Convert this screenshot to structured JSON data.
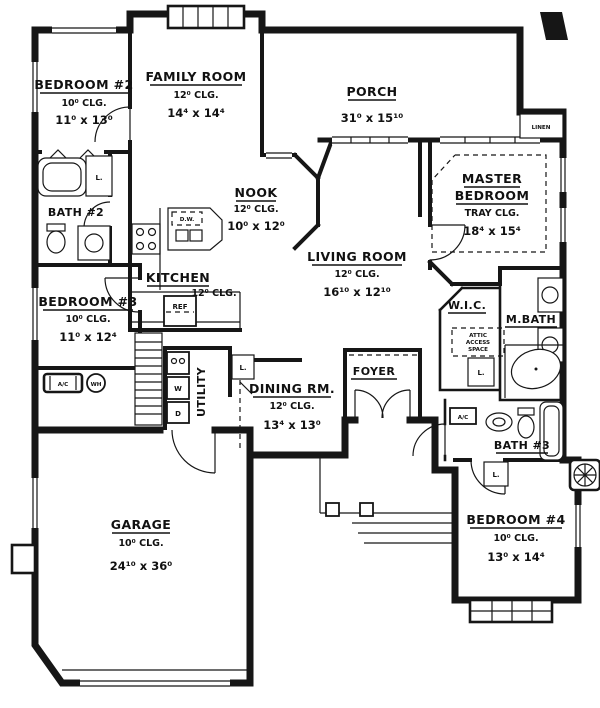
{
  "rooms": {
    "bedroom2": {
      "label": "BEDROOM #2",
      "clg": "10⁰ CLG.",
      "dims": "11⁰ x 13⁰"
    },
    "familyRoom": {
      "label": "FAMILY ROOM",
      "clg": "12⁰ CLG.",
      "dims": "14⁴ x 14⁴"
    },
    "porch": {
      "label": "PORCH",
      "dims": "31⁰ x 15¹⁰"
    },
    "master": {
      "label1": "MASTER",
      "label2": "BEDROOM",
      "clg": "TRAY CLG.",
      "dims": "18⁴ x 15⁴"
    },
    "nook": {
      "label": "NOOK",
      "clg": "12⁰ CLG.",
      "dims": "10⁰ x 12⁰"
    },
    "living": {
      "label": "LIVING ROOM",
      "clg": "12⁰ CLG.",
      "dims": "16¹⁰ x 12¹⁰"
    },
    "bath2": {
      "label": "BATH #2"
    },
    "bedroom3": {
      "label": "BEDROOM #3",
      "clg": "10⁰ CLG.",
      "dims": "11⁰ x 12⁴"
    },
    "kitchen": {
      "label": "KITCHEN",
      "clg": "12⁰ CLG."
    },
    "wic": {
      "label": "W.I.C."
    },
    "mbath": {
      "label": "M.BATH"
    },
    "utility": {
      "label": "UTILITY"
    },
    "dining": {
      "label": "DINING RM.",
      "clg": "12⁰ CLG.",
      "dims": "13⁴ x 13⁰"
    },
    "foyer": {
      "label": "FOYER"
    },
    "bath3": {
      "label": "BATH #3"
    },
    "bedroom4": {
      "label": "BEDROOM #4",
      "clg": "10⁰ CLG.",
      "dims": "13⁰ x 14⁴"
    },
    "garage": {
      "label": "GARAGE",
      "clg": "10⁰ CLG.",
      "dims": "24¹⁰ x 36⁰"
    }
  },
  "annotations": {
    "linen": "LINEN",
    "closet": "L.",
    "ac": "A/C",
    "waterHeater": "WH",
    "dishwasher": "D.W.",
    "refrigerator": "REF",
    "washer": "W",
    "dryer": "D",
    "attic1": "ATTIC",
    "attic2": "ACCESS",
    "attic3": "SPACE"
  },
  "colors": {
    "ink": "#161616",
    "paper": "#ffffff"
  }
}
